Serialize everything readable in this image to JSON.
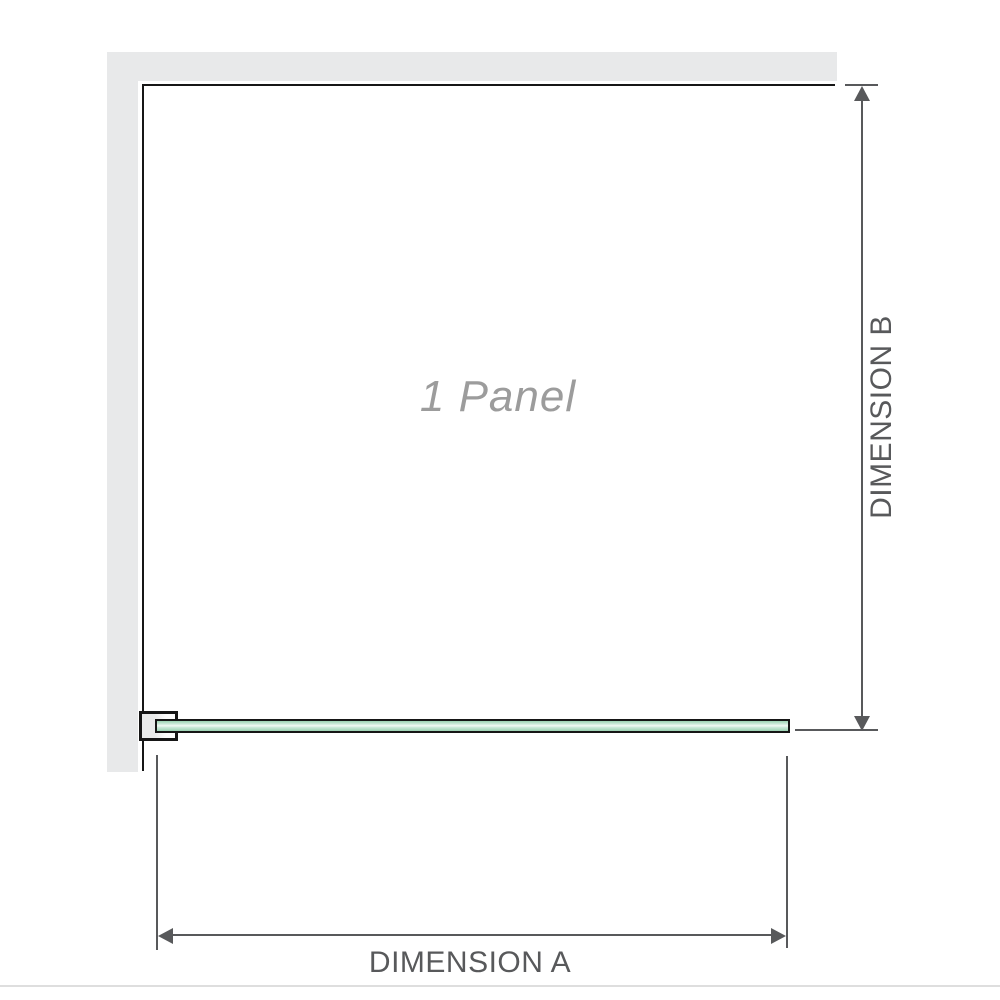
{
  "diagram": {
    "panel_label": "1 Panel",
    "dimension_a": {
      "label": "DIMENSION A"
    },
    "dimension_b": {
      "label": "DIMENSION B"
    }
  },
  "icons": {
    "dim_b_arrow_up": "css-triangle-up",
    "dim_b_arrow_down": "css-triangle-down",
    "dim_a_arrow_left": "css-triangle-left",
    "dim_a_arrow_right": "css-triangle-right"
  },
  "colors": {
    "background": "#ffffff",
    "wall": "#e8e9ea",
    "outline": "#161616",
    "dimension": "#58595b",
    "label_gray": "#9c9c9c",
    "glass_dark": "#9bd2b2",
    "glass_mid": "#cdeadb",
    "glass_light": "#f2f9f4",
    "bracket_fill": "#e9eaea",
    "bottom_rule": "#dedede"
  }
}
